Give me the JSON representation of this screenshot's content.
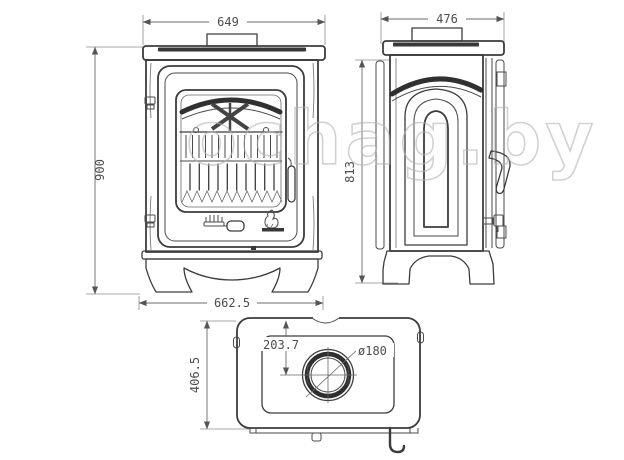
{
  "watermark": {
    "text": "ochag.by"
  },
  "dimensions": {
    "front": {
      "top_width": "649",
      "height": "900",
      "base_width": "662.5"
    },
    "side": {
      "depth": "476",
      "body_height": "813"
    },
    "top": {
      "overall_depth": "406.5",
      "flue_center_offset": "203.7",
      "flue_diameter": "ø180"
    }
  },
  "colors": {
    "line": "#3c3c3c",
    "dim_text": "#4d4d4d",
    "watermark": "#b2b2b2",
    "background": "#ffffff"
  }
}
